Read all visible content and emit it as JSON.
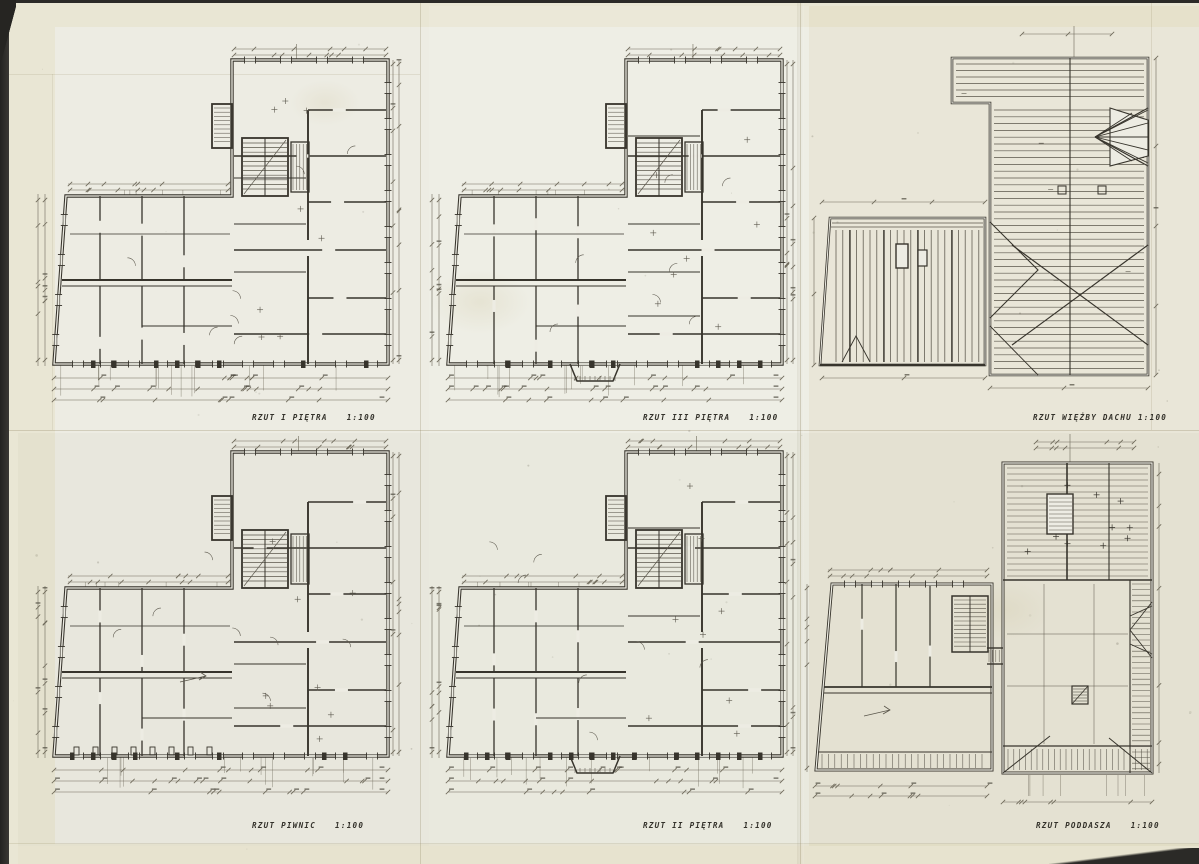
{
  "sheet": {
    "panels": [
      {
        "id": "first-floor",
        "title": "RZUT  I PIĘTRA",
        "scale": "1:100"
      },
      {
        "id": "third-floor",
        "title": "RZUT III PIĘTRA",
        "scale": "1:100"
      },
      {
        "id": "roof-truss",
        "title": "RZUT WIĘŻBY DACHU",
        "scale": "1:100"
      },
      {
        "id": "cellar",
        "title": "RZUT  PIWNIC",
        "scale": "1:100"
      },
      {
        "id": "second-floor",
        "title": "RZUT II PIĘTRA",
        "scale": "1:100"
      },
      {
        "id": "attic",
        "title": "RZUT PODDASZA",
        "scale": "1:100"
      }
    ],
    "colors": {
      "paper": "#e9e6d4",
      "drawing_paper": "#edece3",
      "ink": "#37342c",
      "scanner_background": "#2b2a27"
    }
  }
}
